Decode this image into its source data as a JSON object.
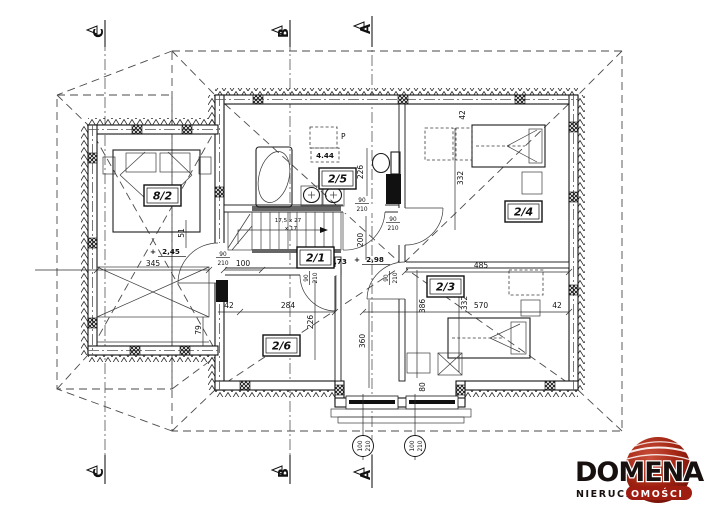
{
  "title": "attic floor plan",
  "sections": {
    "top": [
      "C",
      "B",
      "A"
    ],
    "bottom": [
      "C",
      "B",
      "A"
    ]
  },
  "rooms": {
    "bedroom_left": "8/2",
    "bathroom": "2/5",
    "hall": "2/1",
    "bedroom_ne": "2/4",
    "bedroom_se": "2/3",
    "room_sw": "2/6"
  },
  "dims": {
    "d345": "345",
    "d100": "100",
    "d51": "51",
    "d79": "79",
    "d42a": "42",
    "d284": "284",
    "d226a": "226",
    "d226b": "226",
    "d200": "200",
    "d42b": "42",
    "d332a": "332",
    "d332b": "332",
    "d485": "485",
    "d570": "570",
    "d386": "386",
    "d42c": "42",
    "d360": "360",
    "d80": "80"
  },
  "levels": {
    "plus": "+",
    "l245": "2,45",
    "l298": "2,98",
    "l373": "3,73",
    "l444": "4.44"
  },
  "door": {
    "n90": "90",
    "n210": "210"
  },
  "window": {
    "n100": "100",
    "n210": "210"
  },
  "stairs": {
    "s1": "17,5 x 27",
    "s2": "x 17"
  },
  "misc": {
    "p": "P"
  },
  "logo": {
    "name": "DOMENA",
    "sub_black": "NIERUCH",
    "sub_red": "OMOŚCI"
  },
  "colors": {
    "logo_red": "#9e1c10",
    "logo_red_light": "#c9503c",
    "line": "#141414"
  }
}
